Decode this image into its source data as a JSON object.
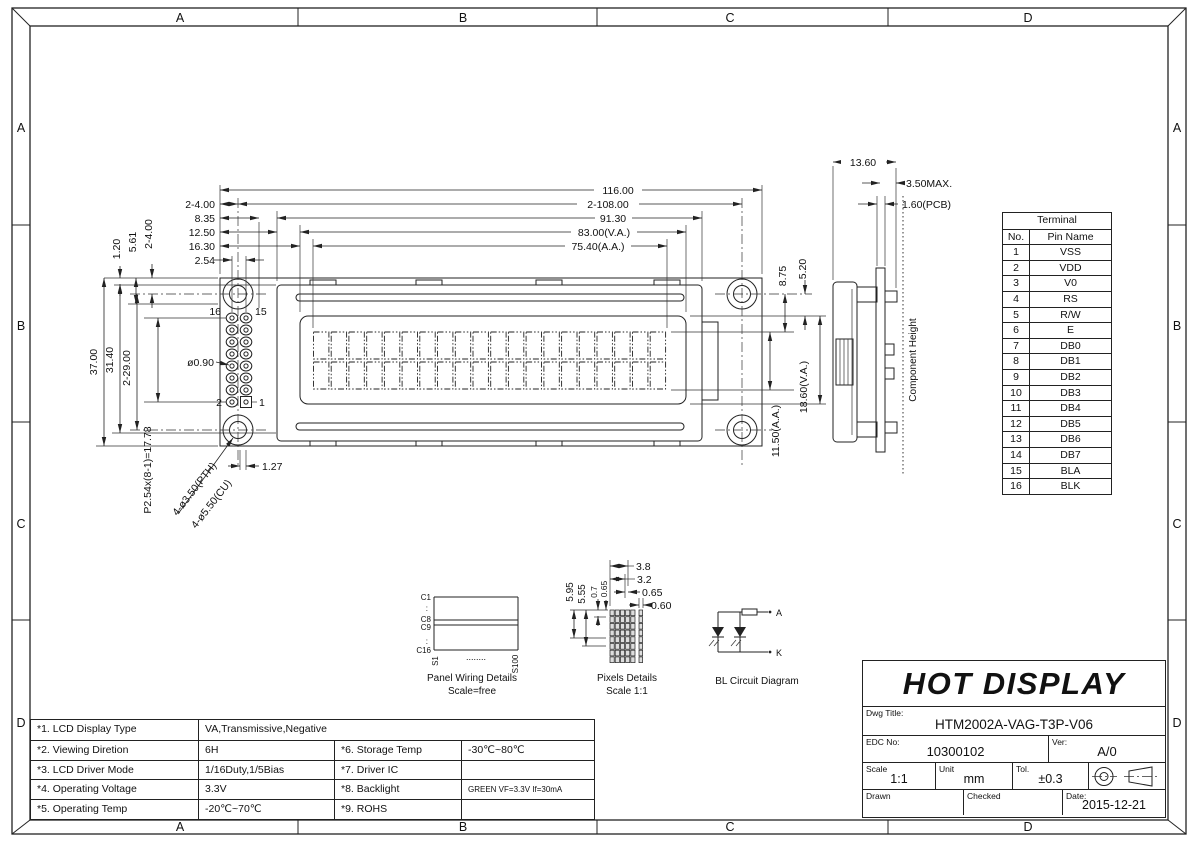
{
  "zones": {
    "top": [
      "A",
      "B",
      "C",
      "D"
    ],
    "bottom": [
      "A",
      "B",
      "C",
      "D"
    ],
    "left": [
      "A",
      "B",
      "C",
      "D"
    ],
    "right": [
      "A",
      "B",
      "C",
      "D"
    ]
  },
  "front_view": {
    "dim_overall_width": "116.00",
    "dim_hole_spacing": "2-108.00",
    "dim_bezel_width": "91.30",
    "dim_va_width": "83.00(V.A.)",
    "dim_aa_width": "75.40(A.A.)",
    "dim_hole_edge": "2-4.00",
    "dim_8_35": "8.35",
    "dim_12_50": "12.50",
    "dim_16_30": "16.30",
    "dim_pin_pitch": "2.54",
    "dim_1_20": "1.20",
    "dim_5_61": "5.61",
    "dim_hole_edge_v": "2-4.00",
    "dim_overall_height": "37.00",
    "dim_bezel_height": "31.40",
    "dim_hole_spacing_v": "2-29.00",
    "dim_pin_row_pitch": "P2.54x(8-1)=17.78",
    "pin_16": "16",
    "pin_15": "15",
    "pin_2": "2",
    "pin_1": "1",
    "dim_pin_hole_dia": "ø0.90",
    "dim_1_27": "1.27",
    "leader_pth": "4-ø3.50(PTH)",
    "leader_cu": "4-ø5.50(CU)",
    "dim_8_75": "8.75",
    "dim_5_20": "5.20",
    "dim_va_height": "18.60(V.A.)",
    "dim_aa_height": "11.50(A.A.)"
  },
  "side_view": {
    "dim_width": "13.60",
    "dim_max": "3.50MAX.",
    "dim_pcb": "1.60(PCB)",
    "component_height": "Component Height"
  },
  "terminal_table": {
    "title": "Terminal",
    "col_no": "No.",
    "col_pin": "Pin Name",
    "rows": [
      [
        "1",
        "VSS"
      ],
      [
        "2",
        "VDD"
      ],
      [
        "3",
        "V0"
      ],
      [
        "4",
        "RS"
      ],
      [
        "5",
        "R/W"
      ],
      [
        "6",
        "E"
      ],
      [
        "7",
        "DB0"
      ],
      [
        "8",
        "DB1"
      ],
      [
        "9",
        "DB2"
      ],
      [
        "10",
        "DB3"
      ],
      [
        "11",
        "DB4"
      ],
      [
        "12",
        "DB5"
      ],
      [
        "13",
        "DB6"
      ],
      [
        "14",
        "DB7"
      ],
      [
        "15",
        "BLA"
      ],
      [
        "16",
        "BLK"
      ]
    ]
  },
  "panel_wiring": {
    "c1": "C1",
    "c8": "C8",
    "c9": "C9",
    "c16": "C16",
    "dots_v1": ":",
    "dots_v2": ":",
    "s1": "S1",
    "s100": "S100",
    "dots_h": "........",
    "title": "Panel Wiring Details",
    "subtitle": "Scale=free"
  },
  "pixels_details": {
    "dim_3_8": "3.8",
    "dim_3_2": "3.2",
    "dim_0_65": "0.65",
    "dim_0_60": "0.60",
    "dim_5_95": "5.95",
    "dim_5_55": "5.55",
    "dim_0_7": "0.7",
    "dim_0_65b": "0.65",
    "title": "Pixels Details",
    "subtitle": "Scale 1:1"
  },
  "bl_circuit": {
    "a": "A",
    "k": "K",
    "title": "BL Circuit Diagram"
  },
  "spec_table": {
    "rows": [
      {
        "label": "*1. LCD Display Type",
        "value": "VA,Transmissive,Negative",
        "label2": "",
        "value2": ""
      },
      {
        "label": "*2. Viewing Diretion",
        "value": "6H",
        "label2": "*6. Storage Temp",
        "value2": "-30℃~80℃"
      },
      {
        "label": "*3. LCD Driver Mode",
        "value": "1/16Duty,1/5Bias",
        "label2": "*7. Driver IC",
        "value2": ""
      },
      {
        "label": "*4. Operating Voltage",
        "value": "3.3V",
        "label2": "*8. Backlight",
        "value2": "GREEN VF=3.3V If=30mA"
      },
      {
        "label": "*5. Operating Temp",
        "value": "-20℃~70℃",
        "label2": "*9. ROHS",
        "value2": ""
      }
    ]
  },
  "title_block": {
    "company": "HOT DISPLAY",
    "dwg_title_label": "Dwg Title:",
    "dwg_title": "HTM2002A-VAG-T3P-V06",
    "edc_label": "EDC No:",
    "edc_no": "10300102",
    "ver_label": "Ver:",
    "ver": "A/0",
    "scale_label": "Scale",
    "scale": "1:1",
    "unit_label": "Unit",
    "unit": "mm",
    "tol_label": "Tol.",
    "tol": "±0.3",
    "drawn_label": "Drawn",
    "checked_label": "Checked",
    "date_label": "Date:",
    "date": "2015-12-21"
  }
}
